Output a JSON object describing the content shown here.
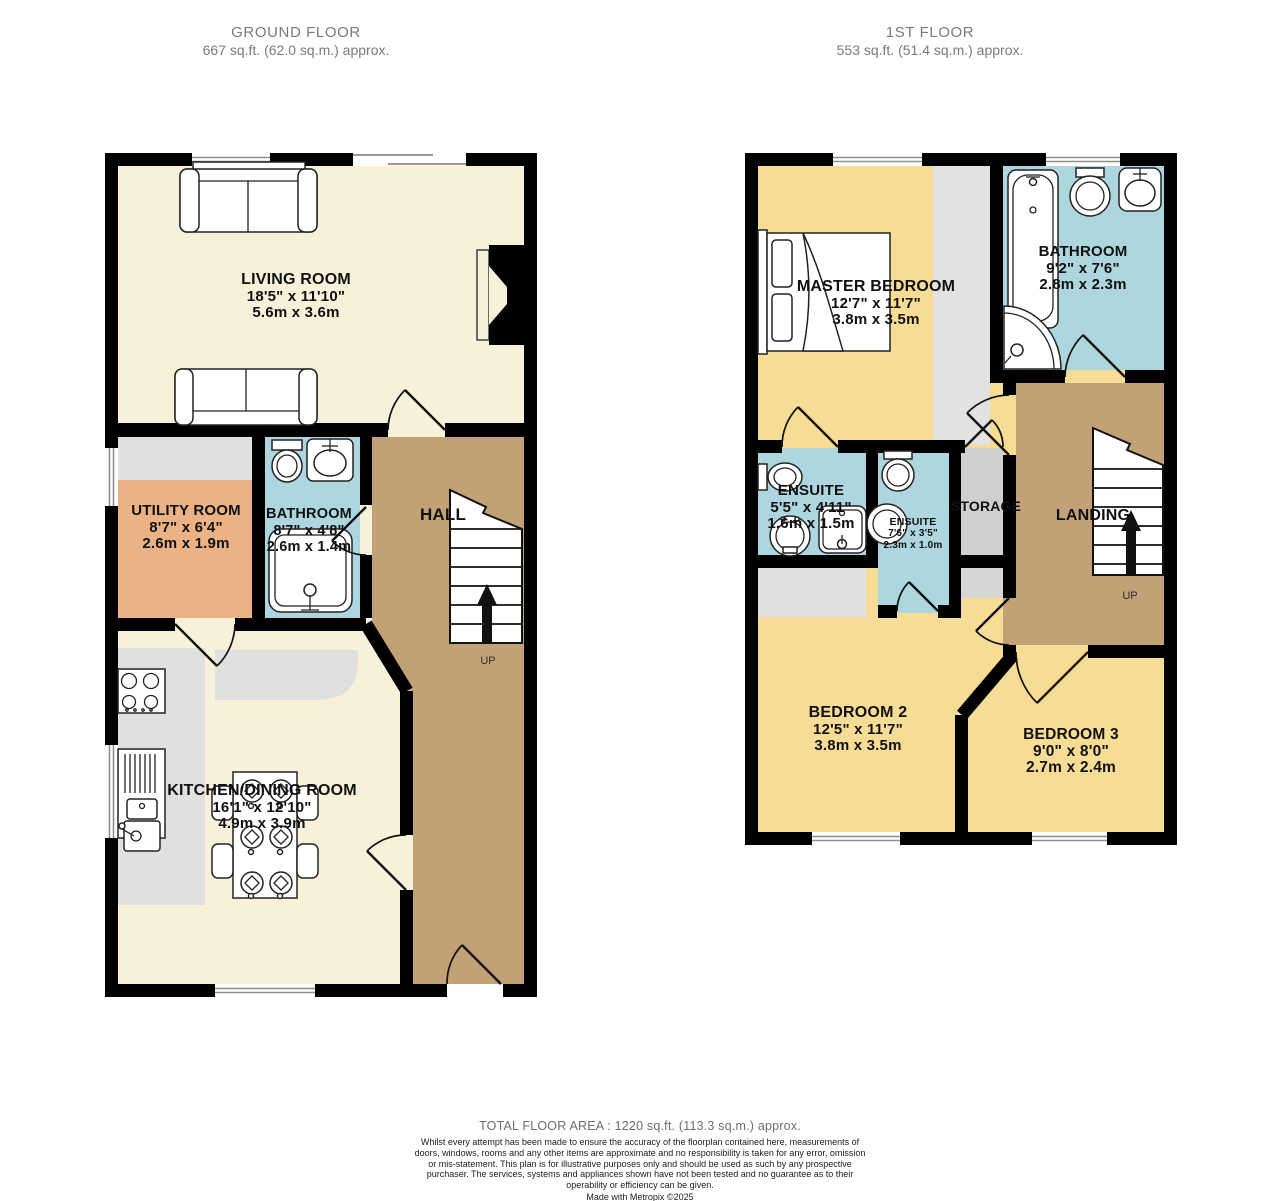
{
  "ground_floor": {
    "title": "GROUND FLOOR",
    "area": "667 sq.ft. (62.0 sq.m.) approx.",
    "stairs_label": "UP",
    "rooms": {
      "living": {
        "name": "LIVING ROOM",
        "imperial": "18'5\" x 11'10\"",
        "metric": "5.6m x 3.6m"
      },
      "utility": {
        "name": "UTILITY ROOM",
        "imperial": "8'7\" x 6'4\"",
        "metric": "2.6m x 1.9m"
      },
      "bathroom": {
        "name": "BATHROOM",
        "imperial": "8'7\" x 4'8\"",
        "metric": "2.6m x 1.4m"
      },
      "hall": {
        "name": "HALL"
      },
      "kitchen": {
        "name": "KITCHEN/DINING ROOM",
        "imperial": "16'1\" x 12'10\"",
        "metric": "4.9m x 3.9m"
      }
    }
  },
  "first_floor": {
    "title": "1ST FLOOR",
    "area": "553 sq.ft. (51.4 sq.m.) approx.",
    "stairs_label": "UP",
    "rooms": {
      "master": {
        "name": "MASTER BEDROOM",
        "imperial": "12'7\" x 11'7\"",
        "metric": "3.8m x 3.5m"
      },
      "bathroom": {
        "name": "BATHROOM",
        "imperial": "9'2\" x 7'6\"",
        "metric": "2.8m x 2.3m"
      },
      "ensuite1": {
        "name": "ENSUITE",
        "imperial": "5'5\" x 4'11\"",
        "metric": "1.6m x 1.5m"
      },
      "ensuite2": {
        "name": "ENSUITE",
        "imperial": "7'6\" x 3'5\"",
        "metric": "2.3m x 1.0m"
      },
      "storage": {
        "name": "STORAGE"
      },
      "landing": {
        "name": "LANDING"
      },
      "bedroom2": {
        "name": "BEDROOM 2",
        "imperial": "12'5\" x 11'7\"",
        "metric": "3.8m x 3.5m"
      },
      "bedroom3": {
        "name": "BEDROOM 3",
        "imperial": "9'0\" x 8'0\"",
        "metric": "2.7m x 2.4m"
      }
    }
  },
  "footer": {
    "total": "TOTAL FLOOR AREA : 1220 sq.ft. (113.3 sq.m.) approx.",
    "disclaimer": "Whilst every attempt has been made to ensure the accuracy of the floorplan contained here, measurements of doors, windows, rooms and any other items are approximate and no responsibility is taken for any error, omission or mis-statement. This plan is for illustrative purposes only and should be used as such by any prospective purchaser. The services, systems and appliances shown have not been tested and no guarantee as to their operability or efficiency can be given.",
    "credit": "Made with Metropix ©2025"
  },
  "colors": {
    "wall": "#000000",
    "living_cream": "#F7F1DA",
    "bedroom_yellow": "#F6DC94",
    "bathroom_blue": "#ADD6DE",
    "utility_orange": "#EAB285",
    "hall_brown": "#C2A177",
    "counter_gray": "#E0E0E0",
    "storage_gray": "#CFCFCF"
  }
}
